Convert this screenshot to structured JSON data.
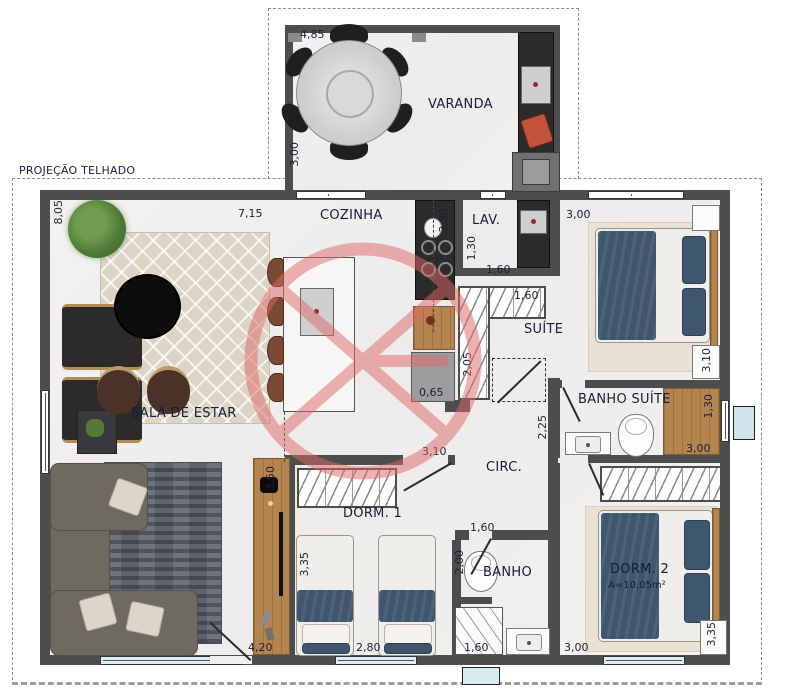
{
  "roof": {
    "label": "PROJEÇÃO TELHADO"
  },
  "rooms": {
    "varanda": {
      "label": "VARANDA",
      "dim_width": "4,85",
      "dim_height": "3,00"
    },
    "sala": {
      "label": "SALA DE ESTAR",
      "dim_left": "8,05",
      "dim_top": "7,15",
      "dim_rack": "3,50",
      "dim_bottom": "4,20"
    },
    "cozinha": {
      "label": "COZINHA",
      "dim_column": "3,50",
      "dim_cabinet": "0,65"
    },
    "lav": {
      "label": "LAV.",
      "dim_width": "1,30",
      "dim_bottom": "1,60"
    },
    "suite": {
      "label": "SUÍTE",
      "dim_top": "3,00",
      "dim_right": "3,10",
      "closet_dim": "1,60",
      "closet_depth": "2,05"
    },
    "banho_suite": {
      "label": "BANHO SUÍTE",
      "dim_corridor": "2,25",
      "dim_shower_side": "1,30",
      "dim_shower_bottom": "3,00"
    },
    "circ": {
      "label": "CIRC.",
      "dim_top": "3,10"
    },
    "dorm1": {
      "label": "DORM. 1",
      "dim_left": "3,35",
      "dim_bottom": "2,80"
    },
    "banho": {
      "label": "BANHO",
      "dim_top": "1,60",
      "dim_side": "2,00",
      "dim_bottom": "1,60"
    },
    "dorm2": {
      "label": "DORM. 2",
      "area": "A=10,05m²",
      "dim_bottom": "3,00",
      "dim_right": "3,35"
    }
  },
  "colors": {
    "wall": "#4e4d4d",
    "floor": "#f1f0ee",
    "label_text": "#141d3a",
    "watermark": "#de6868",
    "bed_blue": "#3e566e",
    "wood": "#b5854f",
    "rug_living": "#dcd4c4",
    "rug_sofa": "#5d646d",
    "glass": "#dcecf2"
  }
}
